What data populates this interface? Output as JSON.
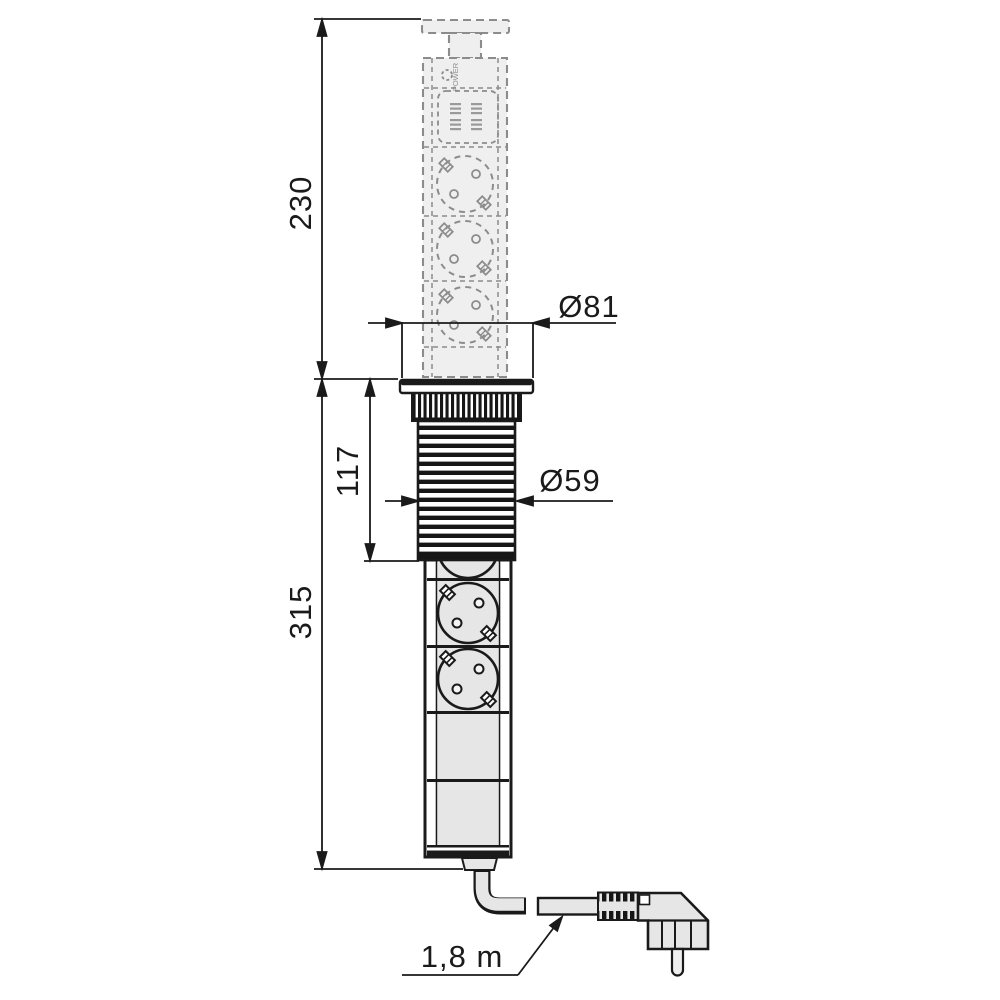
{
  "drawing": {
    "type": "technical-drawing",
    "subject": "Retractable pop-up power socket column (3 Schuko sockets, USB module) with mains plug",
    "dimensions": {
      "extended_height_mm": "230",
      "overall_height_mm": "315",
      "tube_length_mm": "117",
      "flange_diameter": "Ø81",
      "tube_diameter": "Ø59",
      "cable_length": "1,8 m"
    },
    "labels": {
      "power_button": "POWER"
    },
    "colors": {
      "line": "#1a1a1a",
      "ghost_line": "#8c8c8c",
      "solid_fill": "#e6e6e6",
      "ghost_fill": "#efefef",
      "background": "#ffffff"
    }
  }
}
